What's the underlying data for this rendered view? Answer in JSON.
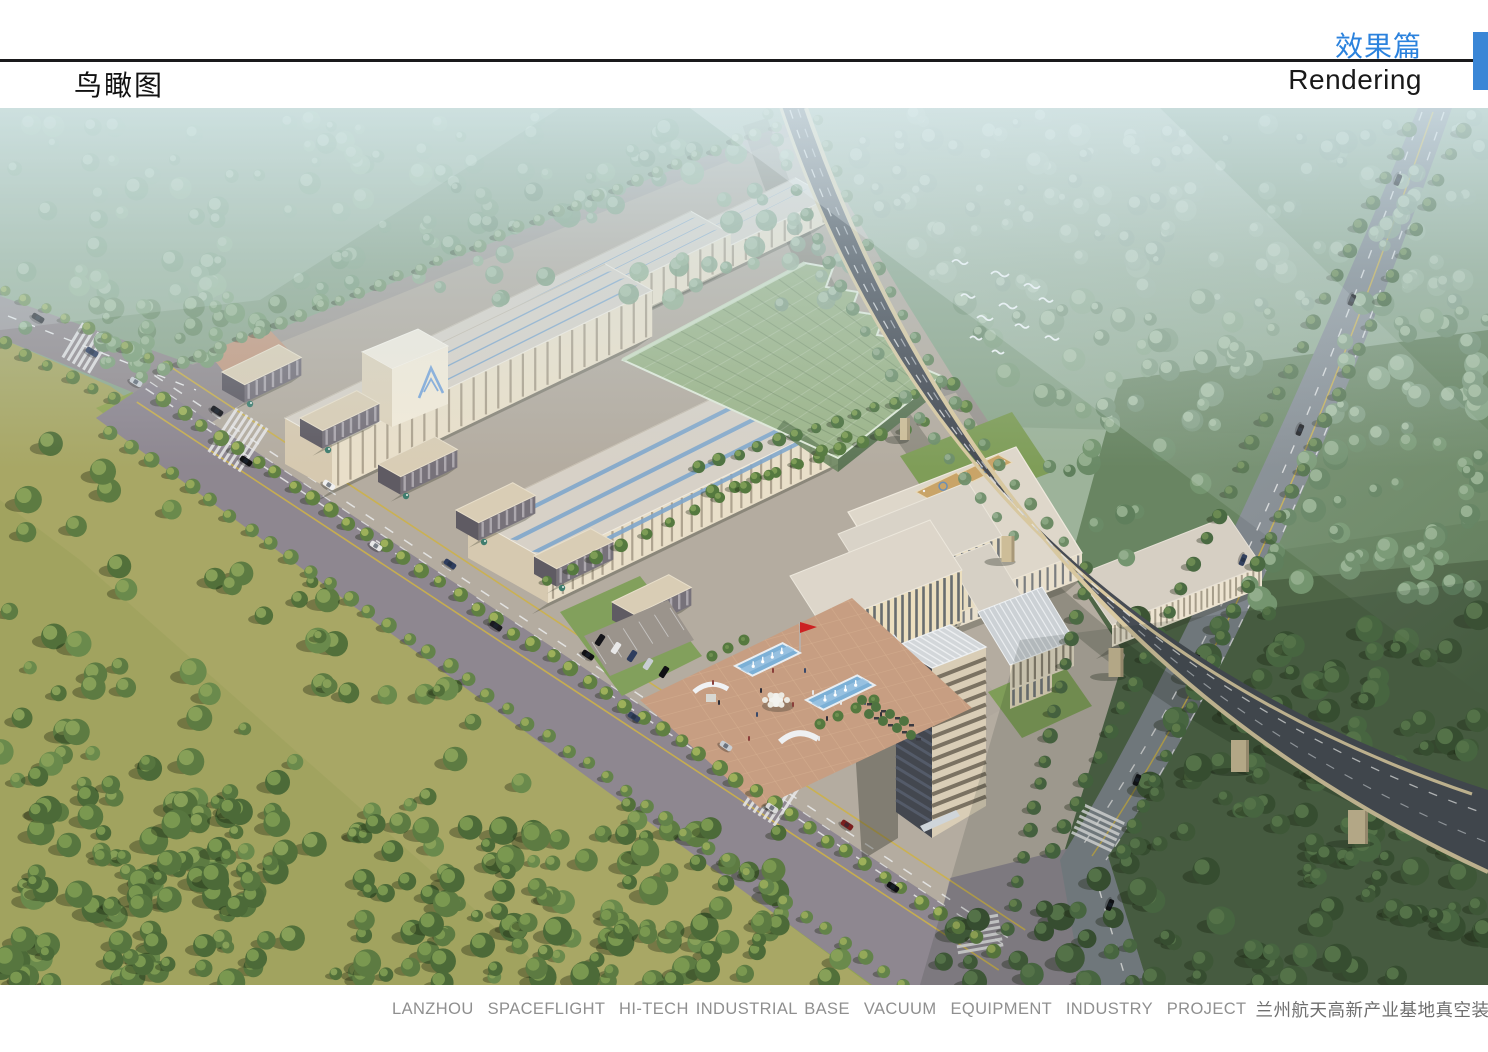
{
  "header": {
    "page_title": "鸟瞰图",
    "section_title_cn": "效果篇",
    "section_title_en": "Rendering",
    "accent_color": "#3a86d6"
  },
  "footer": {
    "caption_en": "LANZHOU  SPACEFLIGHT  HI-TECH INDUSTRIAL BASE  VACUUM  EQUIPMENT  INDUSTRY  PROJECT",
    "caption_cn": "兰州航天高新产业基地真空装备产业园项目",
    "accent_color": "#3f8edb"
  }
}
